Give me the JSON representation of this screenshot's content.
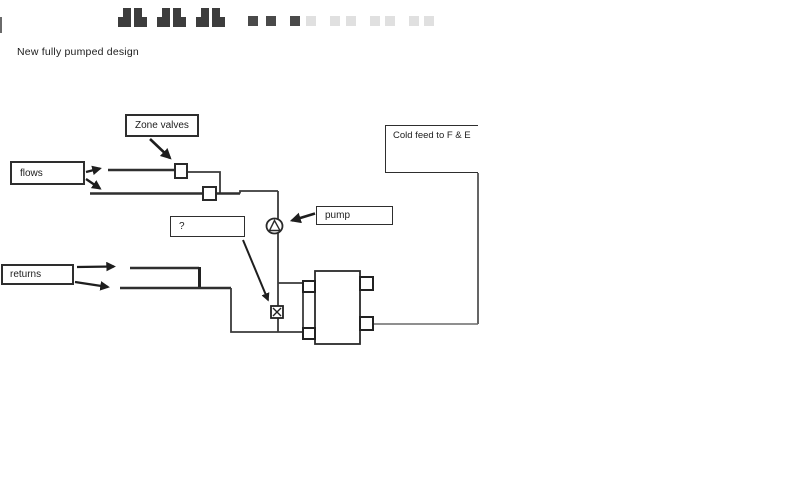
{
  "title": "New fully pumped design",
  "labels": {
    "zone_valves": "Zone valves",
    "flows": "flows",
    "returns": "returns",
    "pump": "pump",
    "question": "?",
    "cold_feed": "Cold feed to F & E"
  },
  "symbols": {
    "pump": "circle-with-triangle",
    "zone_valve": "open-square-on-pipe",
    "bypass_valve": "boxed-x"
  },
  "colors": {
    "background": "#ffffff",
    "pipe_line": "#3a3a3a",
    "box_border": "#2e2e2e",
    "text": "#1c1c1c",
    "cold_feed_line": "#6a6a6a",
    "top_artifact_dark": "#3d3d3d",
    "top_artifact_faint": "#e0e0e0"
  }
}
